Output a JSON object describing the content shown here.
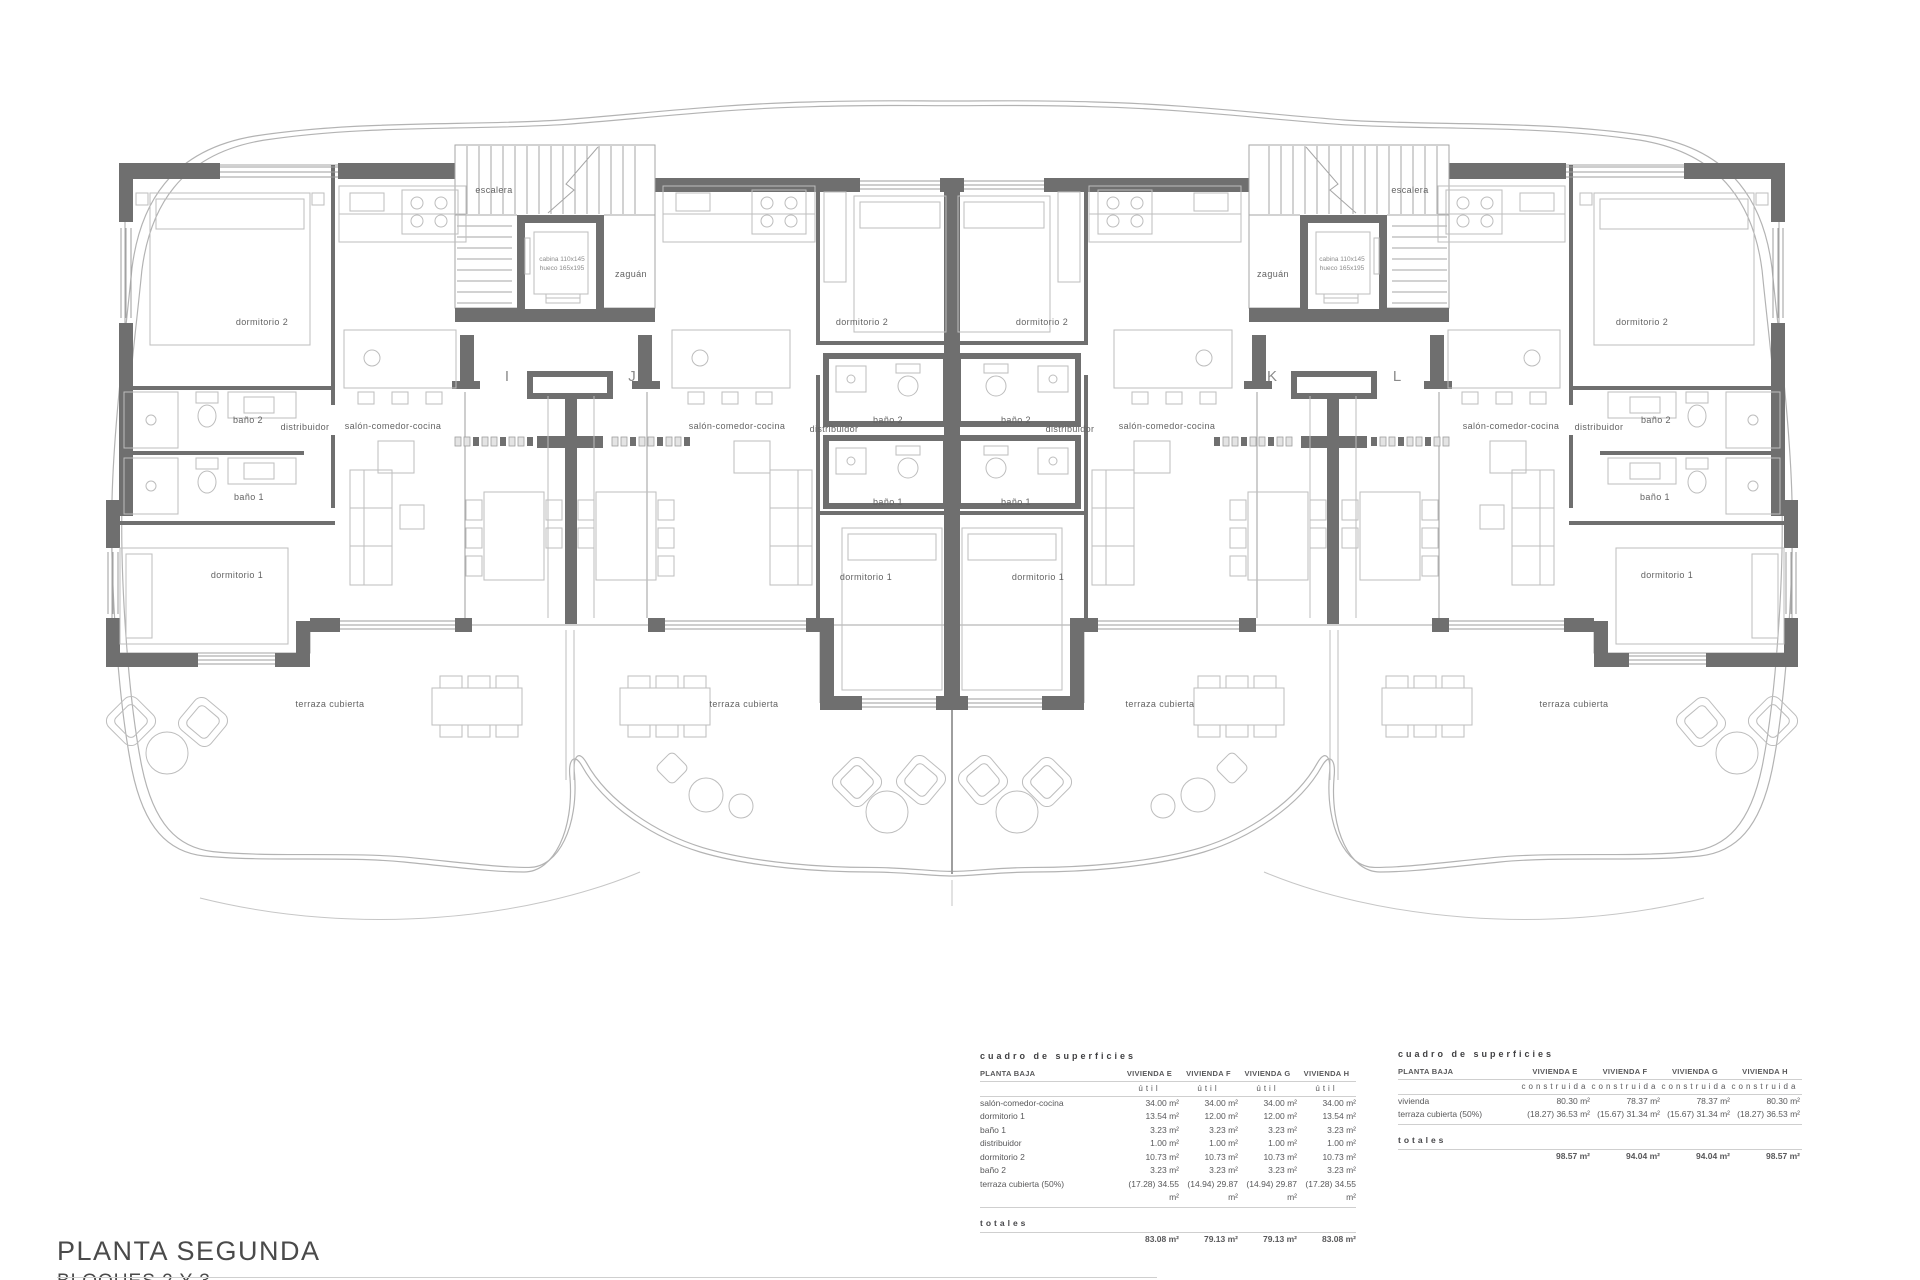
{
  "title": {
    "main": "PLANTA SEGUNDA",
    "sub": "BLOQUES 2 Y 3"
  },
  "plan": {
    "labels": {
      "dormitorio1": "dormitorio 1",
      "dormitorio2": "dormitorio 2",
      "bano1": "baño 1",
      "bano2": "baño 2",
      "distribuidor": "distribuidor",
      "salon": "salón-comedor-cocina",
      "terraza": "terraza cubierta",
      "escalera": "escalera",
      "zaguan": "zaguán"
    },
    "units": {
      "i": "I",
      "j": "J",
      "k": "K",
      "l": "L"
    },
    "elevator": {
      "cabina": "cabina 110x145",
      "hueco": "hueco 165x195"
    },
    "colors": {
      "wall": "#6f6f6f",
      "line": "#a6a6a6",
      "boundary": "#b3b3b3",
      "text": "#636363"
    }
  },
  "tables": {
    "util": {
      "heading": "cuadro de superficies",
      "col0": "PLANTA BAJA",
      "columns": [
        "VIVIENDA E",
        "VIVIENDA F",
        "VIVIENDA G",
        "VIVIENDA H"
      ],
      "subheader": "útil",
      "rows": [
        {
          "label": "salón-comedor-cocina",
          "values": [
            "34.00 m²",
            "34.00 m²",
            "34.00 m²",
            "34.00 m²"
          ]
        },
        {
          "label": "dormitorio 1",
          "values": [
            "13.54 m²",
            "12.00 m²",
            "12.00 m²",
            "13.54 m²"
          ]
        },
        {
          "label": "baño 1",
          "values": [
            "3.23 m²",
            "3.23 m²",
            "3.23 m²",
            "3.23 m²"
          ]
        },
        {
          "label": "distribuidor",
          "values": [
            "1.00 m²",
            "1.00 m²",
            "1.00 m²",
            "1.00 m²"
          ]
        },
        {
          "label": "dormitorio 2",
          "values": [
            "10.73 m²",
            "10.73 m²",
            "10.73 m²",
            "10.73 m²"
          ]
        },
        {
          "label": "baño 2",
          "values": [
            "3.23 m²",
            "3.23 m²",
            "3.23 m²",
            "3.23 m²"
          ]
        },
        {
          "label": "terraza cubierta (50%)",
          "values": [
            "(17.28) 34.55 m²",
            "(14.94) 29.87 m²",
            "(14.94) 29.87 m²",
            "(17.28) 34.55 m²"
          ]
        }
      ],
      "totals_label": "totales",
      "totals": [
        "83.08 m²",
        "79.13 m²",
        "79.13 m²",
        "83.08 m²"
      ]
    },
    "construida": {
      "heading": "cuadro de superficies",
      "col0": "PLANTA BAJA",
      "columns": [
        "VIVIENDA E",
        "VIVIENDA F",
        "VIVIENDA G",
        "VIVIENDA H"
      ],
      "subheader": "construida",
      "rows": [
        {
          "label": "vivienda",
          "values": [
            "80.30 m²",
            "78.37 m²",
            "78.37 m²",
            "80.30 m²"
          ]
        },
        {
          "label": "terraza cubierta (50%)",
          "values": [
            "(18.27) 36.53 m²",
            "(15.67) 31.34 m²",
            "(15.67) 31.34 m²",
            "(18.27) 36.53 m²"
          ]
        }
      ],
      "totals_label": "totales",
      "totals": [
        "98.57 m²",
        "94.04 m²",
        "94.04 m²",
        "98.57 m²"
      ]
    }
  }
}
